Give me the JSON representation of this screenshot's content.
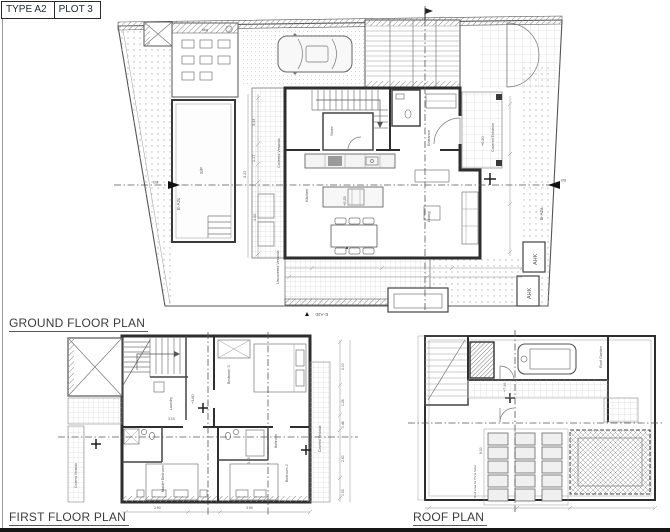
{
  "title": {
    "type_label": "TYPE A2",
    "plot_label": "PLOT 3"
  },
  "colors": {
    "wall": "#2e2e2e",
    "thin_line": "#777777",
    "stipple": "#b3b3b3",
    "paper": "#ffffff",
    "label": "#3c3c3c"
  },
  "plans": {
    "ground": {
      "label": "GROUND FLOOR PLAN",
      "rooms": {
        "kitchen": "Kitchen",
        "living": "Living",
        "store": "Store",
        "entrance": "Entrance",
        "covered_entrance": "Covered Entrance",
        "covered_veranda": "Covered Veranda",
        "uncovered_veranda": "Uncovered Veranda",
        "pool": "S/P",
        "bbq": "bbq",
        "ahk_1": "AHK",
        "ahk_2": "AHK"
      },
      "levels": {
        "main": "+0.25",
        "entrance": "+0.20"
      },
      "markers": {
        "left": "E-A2c",
        "right": "E-A2a",
        "bottom": "E-A2b",
        "b3_left": "B3",
        "b3_right": "B3"
      },
      "dims": [
        "3.44",
        "1.17",
        "3.22",
        "4.00"
      ]
    },
    "first": {
      "label": "FIRST FLOOR PLAN",
      "rooms": {
        "bedroom3": "Bedroom 3",
        "bedroom2": "Bedroom 2",
        "master": "Master Bedroom",
        "laundry": "Laundry",
        "bathroom": "Bathroom",
        "veranda_right": "Covered Veranda",
        "veranda_left": "Covered Veranda"
      },
      "levels": {
        "main": "+3.80"
      },
      "dims": [
        "3.90",
        "3.25",
        "3.15",
        "2.00",
        "1.26",
        "0.46",
        "2.60",
        "0.53"
      ]
    },
    "roof": {
      "label": "ROOF PLAN",
      "rooms": {
        "roof_garden": "Roof Garden"
      },
      "notes": {
        "pv": "Roof area for PV & Solar"
      },
      "levels": {
        "main": "+7.10"
      },
      "dims": [
        "8.30"
      ]
    }
  }
}
